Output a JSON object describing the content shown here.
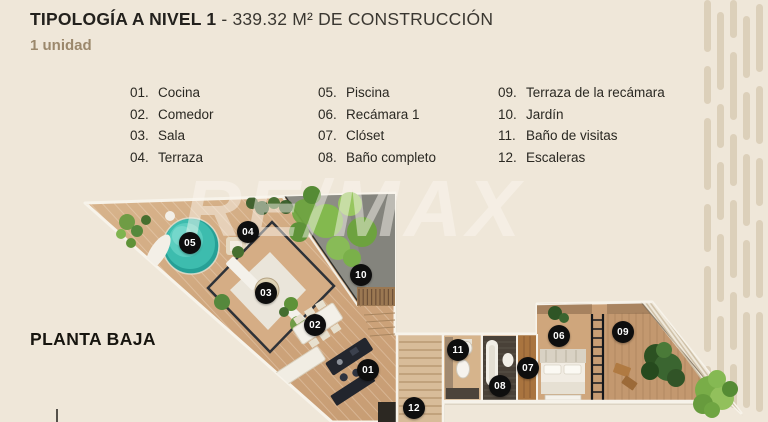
{
  "header": {
    "title_bold": "TIPOLOGÍA A NIVEL 1",
    "title_separator": " - ",
    "title_regular": "339.32 M² DE CONSTRUCCIÓN",
    "subtitle": "1 unidad"
  },
  "legend": {
    "columns": [
      {
        "items": [
          {
            "num": "01.",
            "label": "Cocina"
          },
          {
            "num": "02.",
            "label": "Comedor"
          },
          {
            "num": "03.",
            "label": "Sala"
          },
          {
            "num": "04.",
            "label": "Terraza"
          }
        ]
      },
      {
        "items": [
          {
            "num": "05.",
            "label": "Piscina"
          },
          {
            "num": "06.",
            "label": "Recámara 1"
          },
          {
            "num": "07.",
            "label": "Clóset"
          },
          {
            "num": "08.",
            "label": "Baño completo"
          }
        ]
      },
      {
        "items": [
          {
            "num": "09.",
            "label": "Terraza de la recámara"
          },
          {
            "num": "10.",
            "label": "Jardín"
          },
          {
            "num": "11.",
            "label": "Baño de visitas"
          },
          {
            "num": "12.",
            "label": "Escaleras"
          }
        ]
      }
    ]
  },
  "plan": {
    "label": "PLANTA BAJA",
    "watermark": "RE/MAX",
    "markers": [
      {
        "num": "01",
        "room": "Cocina"
      },
      {
        "num": "02",
        "room": "Comedor"
      },
      {
        "num": "03",
        "room": "Sala"
      },
      {
        "num": "04",
        "room": "Terraza"
      },
      {
        "num": "05",
        "room": "Piscina"
      },
      {
        "num": "06",
        "room": "Recámara 1"
      },
      {
        "num": "07",
        "room": "Clóset"
      },
      {
        "num": "08",
        "room": "Baño completo"
      },
      {
        "num": "09",
        "room": "Terraza de la recámara"
      },
      {
        "num": "10",
        "room": "Jardín"
      },
      {
        "num": "11",
        "room": "Baño de visitas"
      },
      {
        "num": "12",
        "room": "Escaleras"
      }
    ]
  },
  "colors": {
    "background": "#efe7d9",
    "stripe": "#d9cbb4",
    "wood": "#cda379",
    "wall_white": "#f7f3ea",
    "pool_teal": "#3dbcae",
    "garden_gray": "#8d8d85",
    "badge_black": "#0e0e0e",
    "accent_tan": "#9b886c",
    "text_dark": "#23211d"
  }
}
